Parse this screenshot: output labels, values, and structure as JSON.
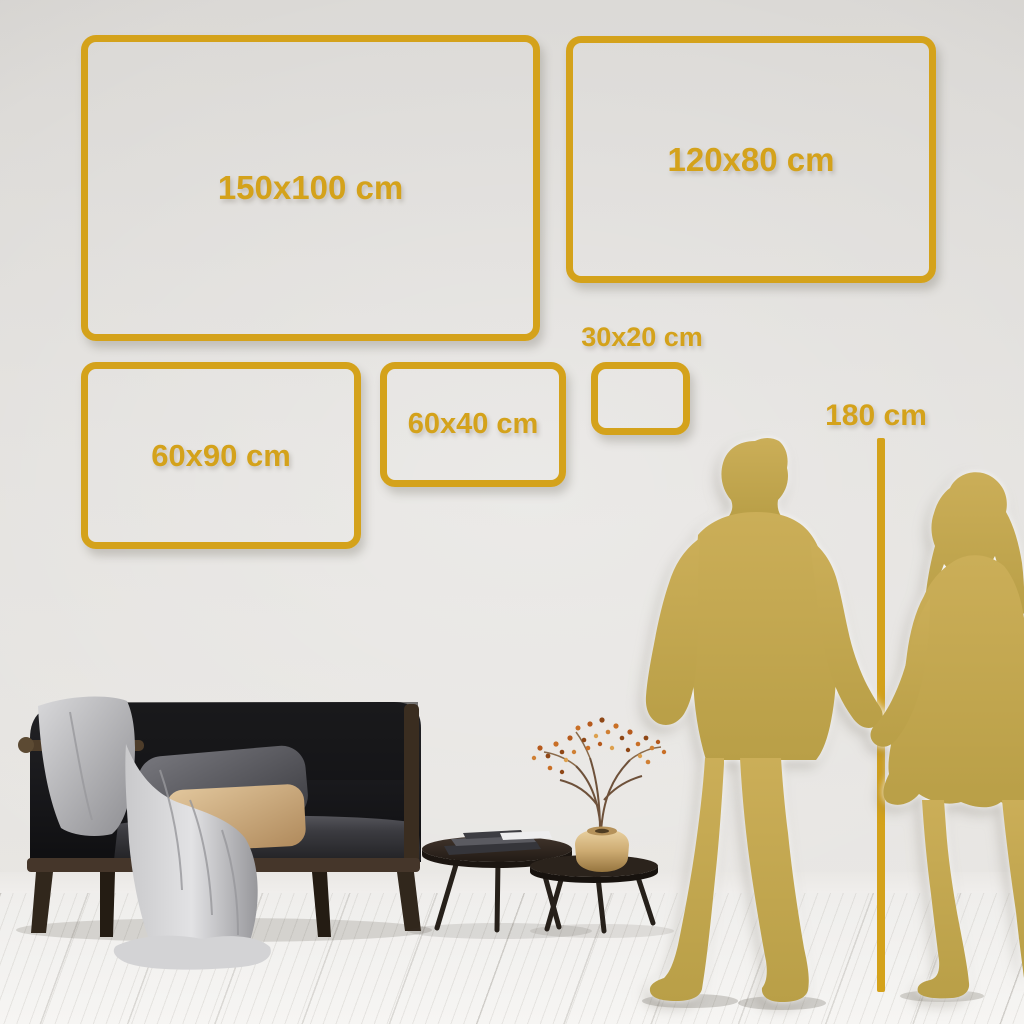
{
  "colors": {
    "gold": "#D4A21B",
    "figure_gold": "#C4A74F",
    "wall": "#E3E1DE",
    "floor": "#F4F3F1"
  },
  "frames": [
    {
      "name": "size-150x100",
      "label": "150x100 cm"
    },
    {
      "name": "size-120x80",
      "label": "120x80 cm"
    },
    {
      "name": "size-60x90",
      "label": "60x90 cm"
    },
    {
      "name": "size-60x40",
      "label": "60x40 cm"
    },
    {
      "name": "size-30x20",
      "label": "30x20 cm"
    }
  ],
  "height_marker": {
    "label": "180 cm"
  },
  "scene_objects": [
    "wall",
    "wood-floor",
    "sofa",
    "throw-blanket",
    "gray-cushion",
    "beige-cushion",
    "nesting-coffee-tables",
    "books",
    "brass-vase",
    "dried-branch",
    "man-silhouette",
    "woman-silhouette",
    "height-ruler-line"
  ]
}
